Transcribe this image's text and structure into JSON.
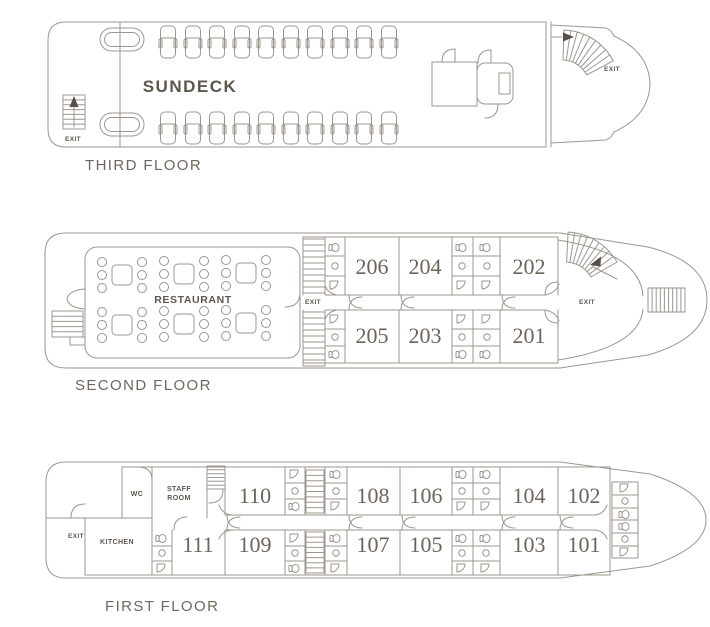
{
  "colors": {
    "background": "#ffffff",
    "line": "#9c968e",
    "text": "#5d564d",
    "floor_label": "#6e675e",
    "cabin_number": "#6b645a"
  },
  "decks": {
    "third": {
      "floor_label": "THIRD FLOOR",
      "area_label": "SUNDECK",
      "exit_stern": "EXIT",
      "exit_bow": "EXIT"
    },
    "second": {
      "floor_label": "SECOND FLOOR",
      "area_label": "RESTAURANT",
      "exit_mid": "EXIT",
      "exit_bow": "EXIT",
      "cabins": [
        "206",
        "204",
        "202",
        "205",
        "203",
        "201"
      ]
    },
    "first": {
      "floor_label": "FIRST FLOOR",
      "exit_stern": "EXIT",
      "rooms": {
        "wc": "WC",
        "staff_line1": "STAFF",
        "staff_line2": "ROOM",
        "kitchen": "KITCHEN"
      },
      "cabins": [
        "110",
        "108",
        "106",
        "104",
        "102",
        "111",
        "109",
        "107",
        "105",
        "103",
        "101"
      ]
    }
  }
}
